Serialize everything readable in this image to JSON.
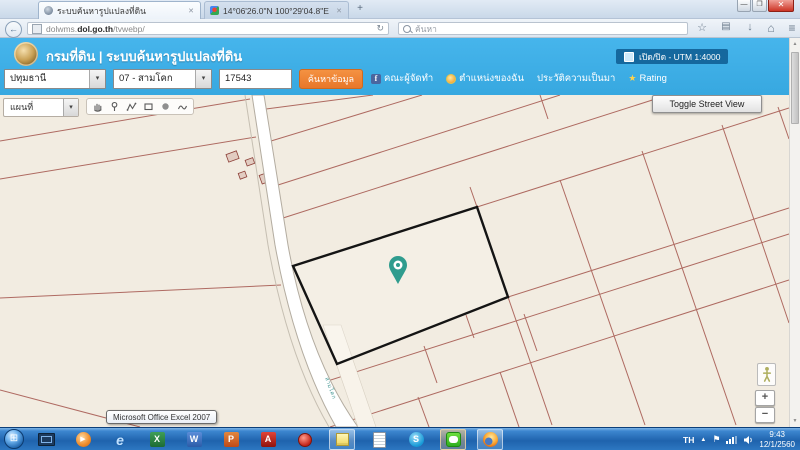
{
  "browser": {
    "tabs": [
      {
        "title": "ระบบค้นหารูปแปลงที่ดิน"
      },
      {
        "title": "14°06'26.0\"N 100°29'04.8\"E ..."
      }
    ],
    "new_tab": "+",
    "url": {
      "subdomain": "dolwms.",
      "domain": "dol.go.th",
      "path": "/tvwebp/"
    },
    "search_placeholder": "ค้นหา",
    "icons": {
      "back": "←",
      "reload": "↻",
      "star": "☆",
      "archive": "▤",
      "download": "↓",
      "home": "⌂",
      "menu": "≡",
      "close": "✕",
      "minimize": "—",
      "maximize": "❐"
    }
  },
  "header": {
    "title": "กรมที่ดิน | ระบบค้นหารูปแปลงที่ดิน",
    "utm_badge": "เปิด/ปิด - UTM 1:4000"
  },
  "search": {
    "province": "ปทุมธานี",
    "district": "07 - สามโคก",
    "parcel_no": "17543",
    "search_button": "ค้นหาข้อมูล",
    "caret": "▾",
    "menu": [
      {
        "label": "คณะผู้จัดทำ"
      },
      {
        "label": "ตำแหน่งของฉัน"
      },
      {
        "label": "ประวัติความเป็นมา"
      },
      {
        "label": "Rating"
      }
    ],
    "icons": {
      "facebook": "f",
      "rating": "★"
    }
  },
  "map": {
    "layer_select": "แผนที่",
    "street_view_button": "Toggle Street View",
    "road_label": "สามโคก",
    "zoom_in": "+",
    "zoom_out": "−",
    "scale": "UTM 1:4000"
  },
  "scrollbar": {
    "up": "▲",
    "down": "▼"
  },
  "tooltip": "Microsoft Office Excel 2007",
  "taskbar": {
    "start_glyph": "⊞",
    "glyphs": {
      "wmp": "▶",
      "ie": "e",
      "excel": "X",
      "word": "W",
      "powerpoint": "P",
      "adobe": "A",
      "skype": "S"
    },
    "tray": {
      "lang": "TH",
      "up": "▲",
      "flag": "⚑",
      "time": "9:43",
      "date": "12/1/2560"
    }
  },
  "colors": {
    "header_blue": "#3FB0E8",
    "badge_blue": "#15689E",
    "button_orange": "#EF8532",
    "map_bg": "#F2ECE1",
    "parcel_line": "#A3544B",
    "selected_parcel_outline": "#141414",
    "pin_teal": "#2F9C8E",
    "taskbar_blue": "#2878C8"
  }
}
